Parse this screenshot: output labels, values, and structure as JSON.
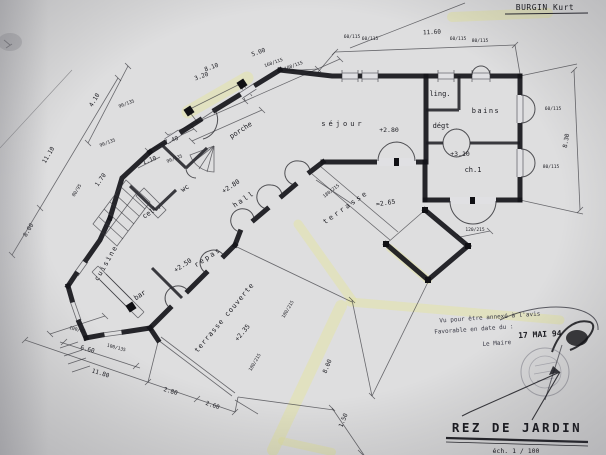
{
  "page": {
    "author": "BURGIN Kurt",
    "title": "REZ  DE  JARDIN",
    "scale": "éch.  1 / 100"
  },
  "rooms": {
    "sejour": "séjour",
    "ling": "ling.",
    "bains": "bains",
    "degt": "dégt",
    "ch1": "ch.1",
    "porche": "porche",
    "hall": "hall",
    "wc": "wc",
    "cell": "cell.",
    "cuisine": "cuisine",
    "bar": "bar",
    "repas": "repas",
    "terrasse_couverte": "terrasse couverte",
    "terrasse": "terrasse"
  },
  "levels": {
    "sejour": "+2.80",
    "hall": "+2.80",
    "ch1": "+3.10",
    "repas": "+2.50",
    "terrasse_couverte": "+2.35",
    "terrasse": "≈2.65"
  },
  "dims": {
    "d1160": "11.60",
    "d830": "8.30",
    "d810": "8.10",
    "d500": "5.00",
    "d320": "3.20",
    "d410": "4.10",
    "d1110": "11.10",
    "d800": "8.00",
    "d660": "6.60",
    "d1180": "11.80",
    "d280": "2.80",
    "d260": "2.60",
    "d150": "1.50",
    "d740": "7.40",
    "d110": "1.10",
    "d170": "1.70"
  },
  "win": {
    "w60_115": "60/115",
    "w80_115": "80/115",
    "w160_115": "160/115",
    "w180_115": "180/115",
    "w90_135": "90/135",
    "w80_95": "80/95",
    "w100_95": "100/95",
    "w100_135": "100/135",
    "w120_215": "120/215",
    "w180_215": "180/215"
  },
  "stamp": {
    "line1": "Vu pour être annexé à l'avis",
    "line2": "Favorable en date du :",
    "date": "17 MAI 94",
    "signatory": "Le Maire"
  }
}
